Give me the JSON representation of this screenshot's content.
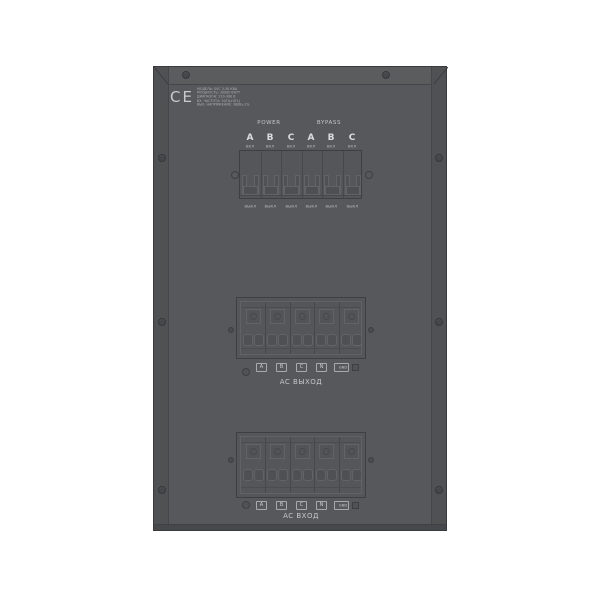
{
  "device": {
    "ce_mark": "CE",
    "spec_label_lines": [
      "МОДЕЛЬ: SVC 3-30 КВА",
      "МОЩНОСТЬ: 30000 ВАТТ",
      "ДИАПАЗОН: 220-380 В",
      "ВХ. ЧАСТОТА: 50ГЦ±5ГЦ",
      "ВЫХ. НАПРЯЖЕНИЕ: 380В±1%"
    ]
  },
  "breaker_panel": {
    "power_label": "POWER",
    "bypass_label": "BYPASS",
    "phases": [
      "A",
      "B",
      "C",
      "A",
      "B",
      "C"
    ],
    "on_label": "ВКЛ",
    "off_label": "ВЫКЛ"
  },
  "output_block": {
    "terminals": [
      "A",
      "B",
      "C",
      "N",
      "GND"
    ],
    "caption": "AC ВЫХОД"
  },
  "input_block": {
    "terminals": [
      "A",
      "B",
      "C",
      "N",
      "GND"
    ],
    "caption": "AC ВХОД"
  },
  "colors": {
    "background": "#ffffff",
    "panel_face": "#57585b",
    "panel_edge": "#3a3b3e",
    "label_text": "#c6c7c9"
  }
}
